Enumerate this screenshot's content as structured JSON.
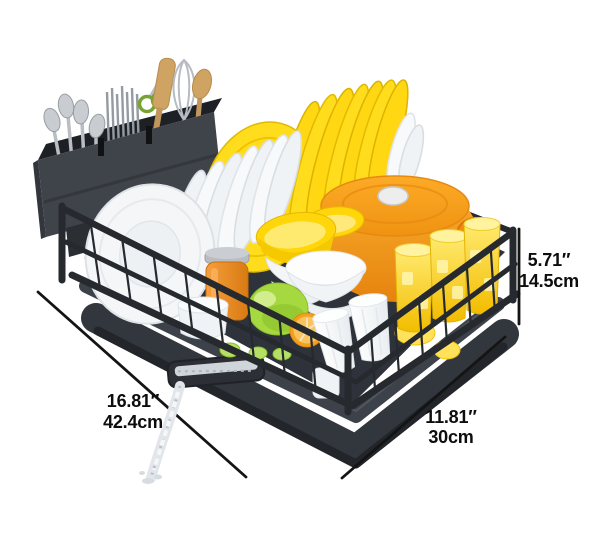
{
  "page": {
    "background": "#ffffff",
    "width": 600,
    "height": 534
  },
  "annotations": {
    "length": {
      "inches": "16.81″",
      "metric": "42.4cm"
    },
    "depth": {
      "inches": "11.81″",
      "metric": "30cm"
    },
    "height": {
      "inches": "5.71″",
      "metric": "14.5cm"
    }
  },
  "colors": {
    "page-bg": "#ffffff",
    "dimension-line": "#141414",
    "label-text": "#0d0d0d",
    "rack-frame": "#26292e",
    "rack-floor": "#2e323a",
    "rack-tray": "#32363d",
    "cutlery-caddy": "#3f434a",
    "plate-white": "#f7f9fb",
    "plate-yellow": "#ffdd1c",
    "pot-orange": "#f79d1e",
    "cup-yellow": "#ffd84a",
    "cup-white": "#f6f8fa",
    "bowl-yellow": "#ffd60a",
    "honey-jar": "#ef8e2a",
    "lime-green": "#a6d840",
    "orange-fruit": "#f3a01f",
    "utensil-steel": "#b9bec5",
    "utensil-wood": "#cfa362",
    "water": "#dce1e6"
  },
  "scene": {
    "items": [
      "dish drying rack",
      "wire basket",
      "drip tray",
      "drain spout",
      "water stream",
      "cutlery caddy",
      "spoons",
      "metal chopsticks",
      "scissors",
      "wooden spatula",
      "whisk",
      "wooden spoon",
      "white plates",
      "yellow plates",
      "orange dutch oven",
      "yellow bowls",
      "white bowls",
      "honey jar",
      "white canister",
      "green pepper",
      "orange slice",
      "lemon slices",
      "yellow tumblers",
      "white tumblers"
    ]
  }
}
